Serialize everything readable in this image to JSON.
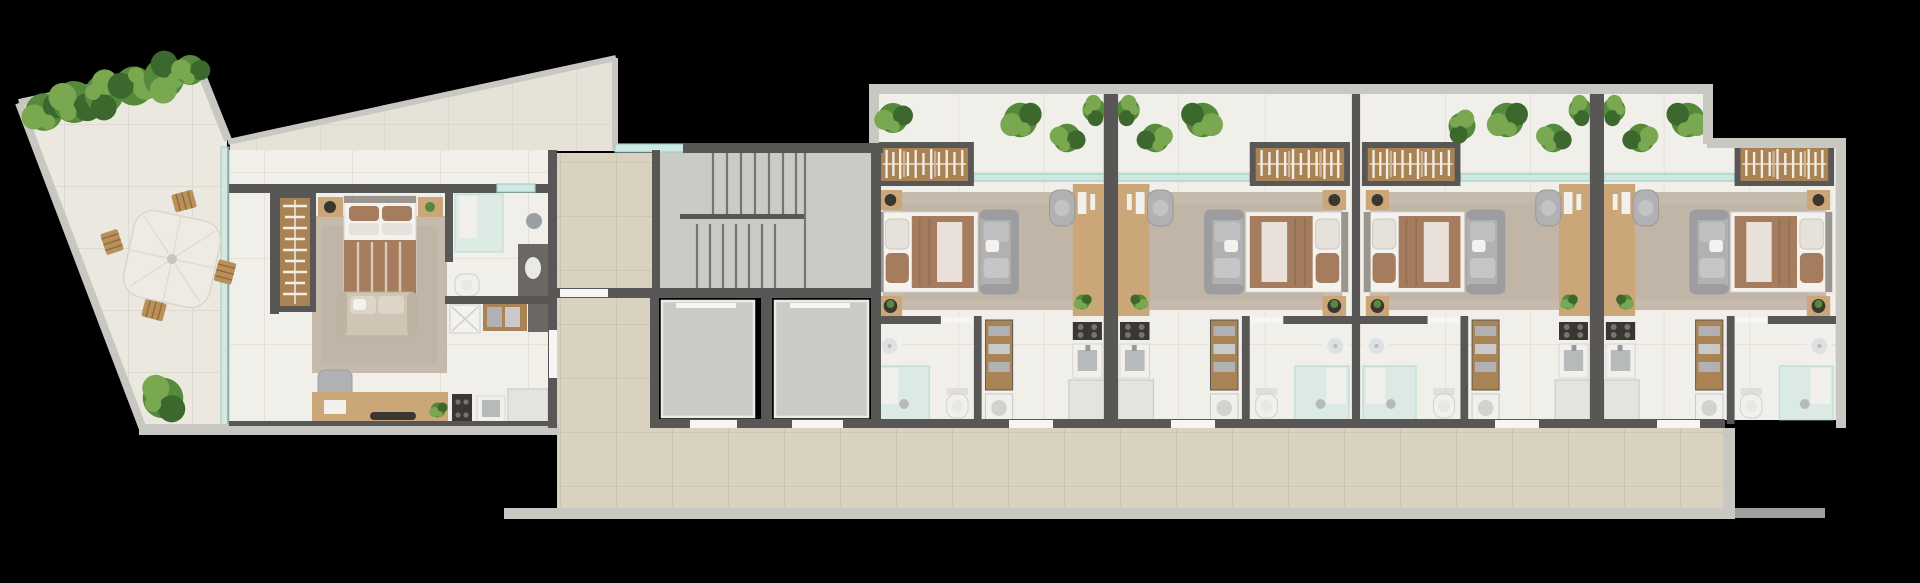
{
  "meta": {
    "title": "Top-down 3D render of an apartment building floor plan on a black background",
    "render_style": "photorealistic top view floor plate",
    "text_content": "none"
  },
  "palette": {
    "background": "#000000",
    "wall_light": "#c9c7c2",
    "wall_dark": "#585755",
    "floor_unit": "#f0efea",
    "floor_unit_line": "#ded9d0",
    "floor_terrace": "#ebe8e0",
    "floor_terrace_line": "#d6d2c7",
    "floor_deck": "#e6e2d8",
    "floor_corridor": "#d9d2c1",
    "floor_corridor_line": "#c6bead",
    "concrete": "#cbcbc6",
    "glass": "#cfe8e2",
    "glass_edge": "#9bcfc5",
    "wood": "#cba678",
    "wood_dark": "#aa8355",
    "wood_outdoor": "#b98f5a",
    "fabric_white": "#f3f2ee",
    "fabric_light": "#e6e1da",
    "fabric_brown": "#a57c5d",
    "fabric_grey": "#b1b1b3",
    "fabric_grey_dark": "#9d9da0",
    "rug": "#c5baac",
    "fixture_white": "#f1f0ed",
    "fixture_dark": "#6b6763",
    "steel": "#b7babb",
    "sill": "#f6f5f2",
    "plant_light": "#79a851",
    "plant_mid": "#558a3c",
    "plant_dark": "#3c682e",
    "accent_black": "#3a3632"
  },
  "floor_plan": {
    "terrace": {
      "label": "Wrap-around roof terrace",
      "features": [
        "hedge planting along sloped top wall",
        "outdoor dining parasol",
        "four wooden slat chairs",
        "potted shrub"
      ]
    },
    "roof_deck": {
      "label": "Triangular tiled deck over entry"
    },
    "garden_unit": {
      "label": "Corner unit with terrace",
      "rooms": [
        "bedroom",
        "bathroom",
        "laundry niche",
        "kitchen and desk strip"
      ],
      "furniture": [
        "wardrobe with hanging clothes",
        "double bed",
        "nightstand with vase",
        "nightstand with plant",
        "area rug",
        "two-seat sofa",
        "lounge chair",
        "desk counter with laptop",
        "cooktop",
        "kitchen sink",
        "refrigerator",
        "glass shower",
        "vanity with basin",
        "toilet",
        "ironing pad",
        "linen shelf",
        "glazed west facade",
        "glass entry door"
      ]
    },
    "core": {
      "staircase": {
        "label": "Staircase",
        "flights": 2,
        "landing": "mid landing"
      },
      "elevators": [
        {
          "id": "elevator-1"
        },
        {
          "id": "elevator-2"
        }
      ],
      "hall": {
        "label": "Lift lobby"
      },
      "corridor": {
        "label": "Access corridor along the south side"
      }
    },
    "units": [
      {
        "id": "unit-1",
        "mirrored": false
      },
      {
        "id": "unit-2",
        "mirrored": true
      },
      {
        "id": "unit-3",
        "mirrored": false
      },
      {
        "id": "unit-4",
        "mirrored": true
      }
    ],
    "unit_template": {
      "rooms": [
        "balcony planting strip behind glass line",
        "living and sleeping area",
        "bathroom",
        "kitchenette with work desk"
      ],
      "furniture": [
        "wardrobe with hanging clothes",
        "double bed with brown duvet",
        "grey sofa",
        "large area rug",
        "side table with vase",
        "side table with plant",
        "work desk with computer",
        "office chair",
        "desk plant",
        "cooktop",
        "kitchen sink",
        "refrigerator",
        "vanity with basin",
        "glass shower",
        "toilet",
        "linen shelf",
        "washing machine",
        "entry door sill"
      ]
    },
    "vegetation": "potted plants and shrubs along balconies, dividers and terrace"
  }
}
